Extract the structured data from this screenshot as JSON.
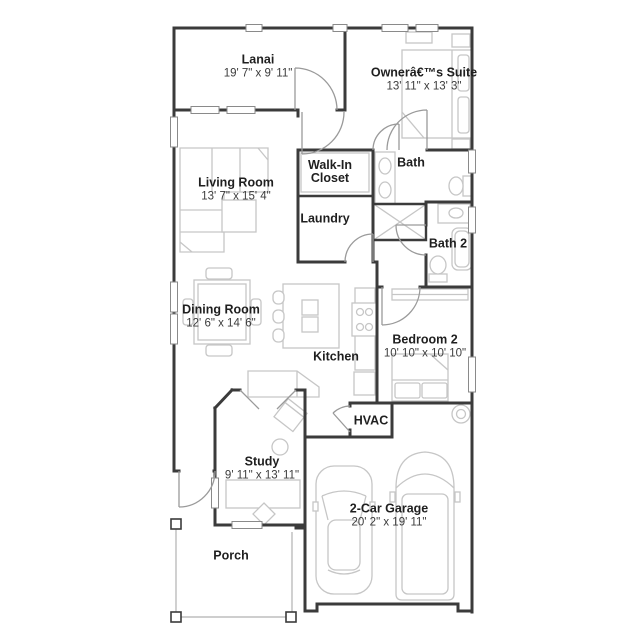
{
  "plan": {
    "title": "Floor plan",
    "rooms": {
      "lanai": {
        "name": "Lanai",
        "dims": "19' 7\" x 9' 11\""
      },
      "owners_suite": {
        "name": "Ownerâ€™s Suite",
        "dims": "13' 11\" x 13' 3\""
      },
      "living_room": {
        "name": "Living Room",
        "dims": "13' 7\" x 15' 4\""
      },
      "walk_in_closet": {
        "name": "Walk-In Closet"
      },
      "bath": {
        "name": "Bath"
      },
      "laundry": {
        "name": "Laundry"
      },
      "bath2": {
        "name": "Bath 2"
      },
      "dining_room": {
        "name": "Dining Room",
        "dims": "12' 6\" x 14' 6\""
      },
      "kitchen": {
        "name": "Kitchen"
      },
      "bedroom2": {
        "name": "Bedroom 2",
        "dims": "10' 10\" x 10' 10\""
      },
      "hvac": {
        "name": "HVAC"
      },
      "study": {
        "name": "Study",
        "dims": "9' 11\" x 13' 11\""
      },
      "garage": {
        "name": "2-Car Garage",
        "dims": "20' 2\" x 19' 11\""
      },
      "porch": {
        "name": "Porch"
      }
    },
    "colors": {
      "wall": "#3b3b3b",
      "furniture": "#c6c6c6",
      "door": "#9a9a9a",
      "background": "#ffffff",
      "label": "#1f1f1f"
    }
  }
}
